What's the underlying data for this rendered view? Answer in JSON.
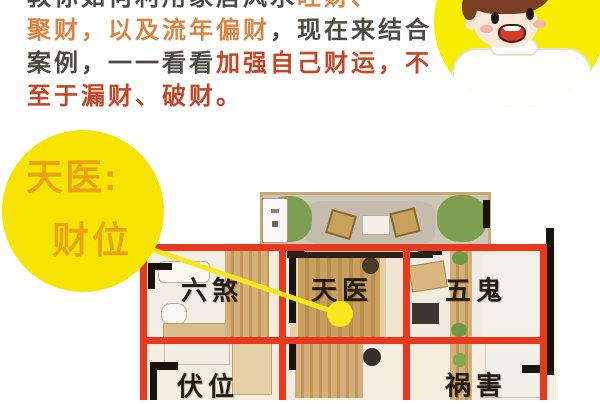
{
  "colors": {
    "accent_yellow": "#F6E400",
    "grid_red": "#E8391F",
    "intro_text_dark": "#4E4A42",
    "intro_text_orange": "#DA8440",
    "intro_text_red": "#C64524",
    "circle_text_orange": "#E9A315",
    "sector_label_black": "#221D15"
  },
  "intro": {
    "line1": {
      "dark": "教你如何利用家居风水",
      "orange": "旺财、"
    },
    "line2": {
      "orange": "聚财，以及流年偏财",
      "dark": "，现在来结合"
    },
    "line3": {
      "dark": "案例，一一看看",
      "red": "加强自己财运，不"
    },
    "line4": {
      "red": "至于漏财、破财。"
    }
  },
  "wealth_circle": {
    "title": "天医:",
    "subtitle": "财位"
  },
  "floorplan": {
    "labels": {
      "liusha": "六煞",
      "tianyi": "天医",
      "wugui": "五鬼",
      "fuwei": "伏位",
      "huohai": "祸害"
    }
  }
}
